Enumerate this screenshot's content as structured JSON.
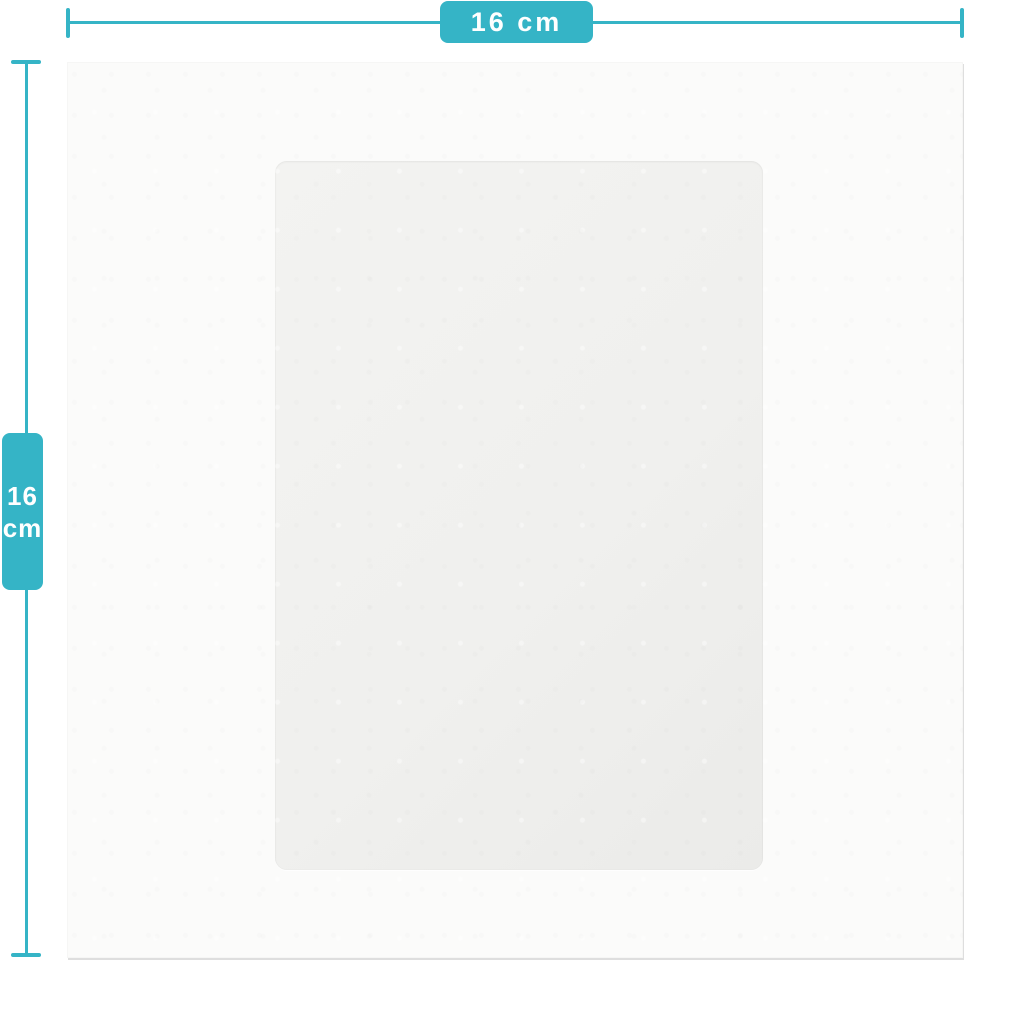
{
  "diagram": {
    "width_dimension": {
      "label": "16 cm"
    },
    "height_dimension": {
      "value": "16",
      "unit": "cm"
    }
  },
  "colors": {
    "accent": "#35b4c6",
    "card_background": "#fbfbfa",
    "panel_background": "#f0f0ee",
    "background": "#ffffff"
  }
}
